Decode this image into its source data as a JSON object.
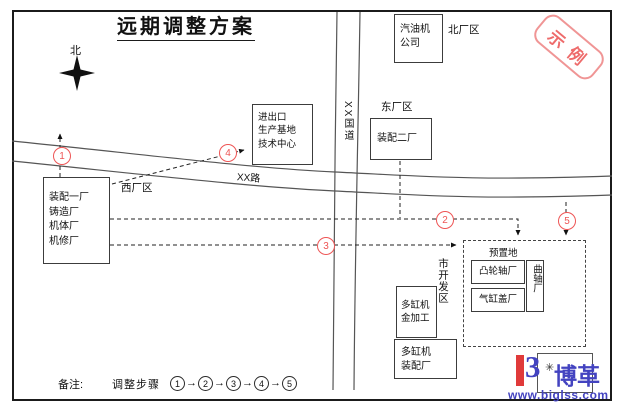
{
  "title": "远期调整方案",
  "stamp": "示例",
  "compass": {
    "label": "北"
  },
  "roads": {
    "horizontal": "XX路",
    "vertical": "XX国道"
  },
  "districts": {
    "north": "北厂区",
    "east": "东厂区",
    "west": "西厂区",
    "city_dev": "市开发区"
  },
  "plants": {
    "gasoline": "汽油机\n公司",
    "import_export": "进出口\n生产基地\n技术中心",
    "assembly2": "装配二厂",
    "west_group": "装配一厂\n铸造厂\n机体厂\n机修厂",
    "camshaft": "凸轮轴厂",
    "cylinder_head": "气缸盖厂",
    "crankshaft": "曲轴厂",
    "machining": "多缸机\n金加工",
    "assembly": "多缸机\n装配厂",
    "reserved_land": "预置地"
  },
  "markers": {
    "s1": "1",
    "s2": "2",
    "s3": "3",
    "s4": "4",
    "s5": "5"
  },
  "note": {
    "label": "备注:",
    "steps_label": "调整步骤",
    "arrow": "→",
    "seq": [
      "1",
      "2",
      "3",
      "4",
      "5"
    ]
  },
  "logo": {
    "glyph": "3",
    "asterisk": "✳",
    "name": "博革",
    "url": "www.biglss.com"
  },
  "colors": {
    "accent_red": "#ee5555",
    "stamp_red": "#ee7777",
    "logo_red": "#e03a3a",
    "logo_blue": "#4343c0"
  }
}
